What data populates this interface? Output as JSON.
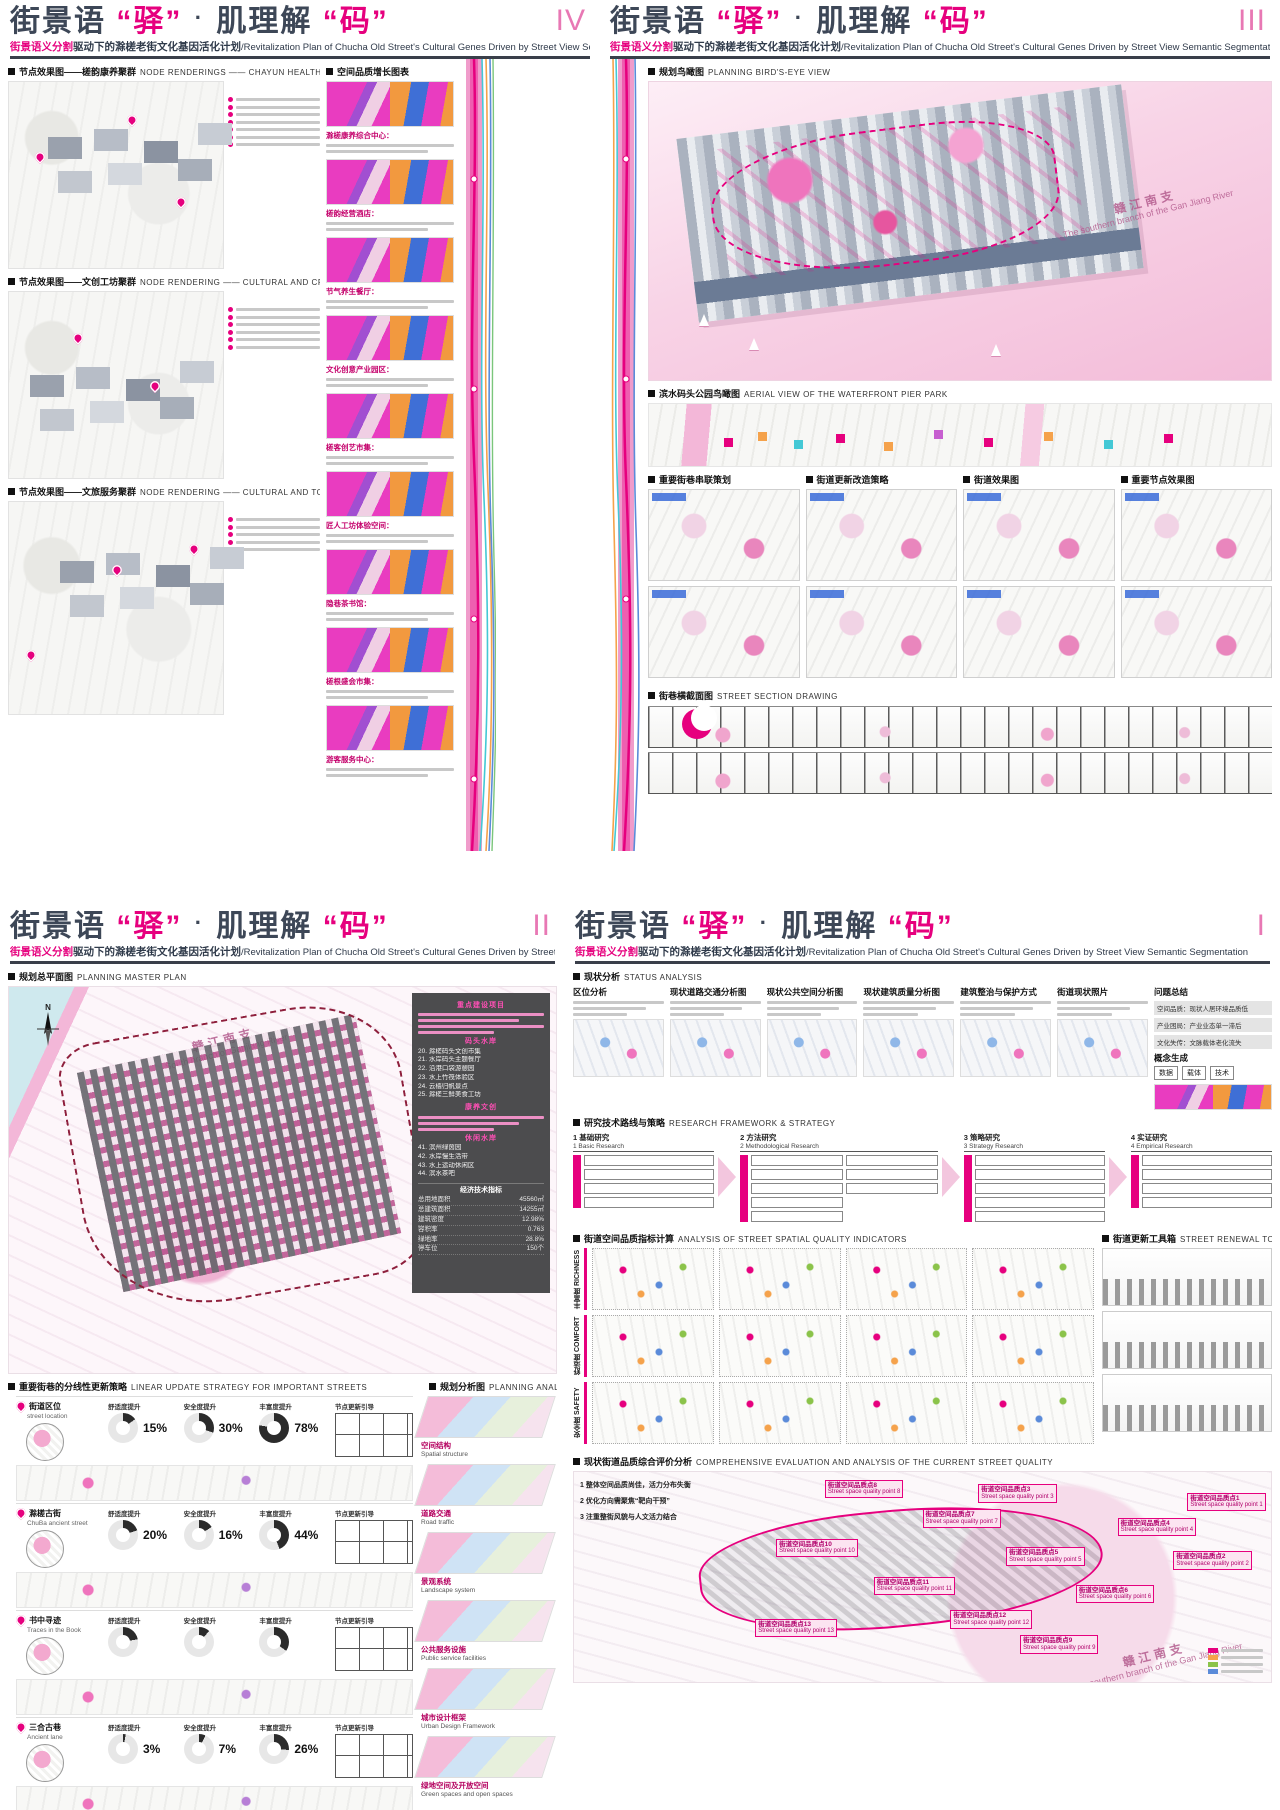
{
  "colors": {
    "accent": "#e6007e",
    "title_dark": "#3d4757",
    "band_pink": "#ee5fb0",
    "water_pink": "#f6c9de"
  },
  "shared": {
    "title": {
      "p1": "街景语",
      "q1": "“驿”",
      "dot": "·",
      "p2": "肌理解",
      "q2": "“码”"
    },
    "subtitle": {
      "pink": "街景语义分割",
      "cn": "驱动下的滁槎老街文化基因活化计划",
      "en": "/Revitalization Plan of Chucha Old Street's Cultural Genes Driven by Street View Semantic Segmentation"
    }
  },
  "panel4": {
    "numeral": "IV",
    "sec1_cn": "节点效果图——槎韵康养聚群",
    "sec1_en": "NODE RENDERINGS —— CHAYUN HEALTH CARE CLUSTER",
    "sec2_cn": "空间品质增长图表",
    "sec2_en": "",
    "sec3_cn": "节点效果图——文创工坊聚群",
    "sec3_en": "NODE RENDERING —— CULTURAL AND CREATIVE WORKSHOP CLUSTER",
    "sec4_cn": "节点效果图——文旅服务聚群",
    "sec4_en": "NODE RENDERING —— CULTURAL AND TOURISM SERVICE CLUSTER",
    "captions": [
      {
        "t": "滁槎康养综合中心："
      },
      {
        "t": "槎韵经营酒店："
      },
      {
        "t": "节气养生餐厅："
      },
      {
        "t": "文化创意产业园区："
      },
      {
        "t": "槎客创艺市集："
      },
      {
        "t": "匠人工坊体验空间："
      },
      {
        "t": "隐巷茶书馆："
      },
      {
        "t": "槎根盛会市集："
      },
      {
        "t": "游客服务中心："
      }
    ]
  },
  "panel3": {
    "numeral": "III",
    "sec1_cn": "规划鸟瞰图",
    "sec1_en": "PLANNING BIRD'S-EYE VIEW",
    "water_cn": "赣江南支",
    "water_en": "The southern branch of the Gan Jiang River",
    "sec2_cn": "滨水码头公园鸟瞰图",
    "sec2_en": "AERIAL VIEW OF THE WATERFRONT PIER PARK",
    "cols": [
      {
        "t": "重要街巷串联策划"
      },
      {
        "t": "街道更新改造策略"
      },
      {
        "t": "街道效果图"
      },
      {
        "t": "重要节点效果图"
      }
    ],
    "sec3_cn": "街巷横截面图",
    "sec3_en": "STREET SECTION DRAWING"
  },
  "panel2": {
    "numeral": "II",
    "sec1_cn": "规划总平面图",
    "sec1_en": "PLANNING MASTER PLAN",
    "compass": "N",
    "water_cn": "赣江南支",
    "water_en": "South branch of Ganjiang River",
    "legend": {
      "g1": "重点建设项目",
      "g2": "码头水岸",
      "g2_items": [
        {
          "t": "20. 滁槎码头文创市集"
        },
        {
          "t": "21. 水岸码头主题餐厅"
        },
        {
          "t": "22. 沿港口袋游憩园"
        },
        {
          "t": "23. 水上竹筏体验区"
        },
        {
          "t": "24. 云樯归帆景点"
        },
        {
          "t": "25. 滁槎三鲜美食工坊"
        }
      ],
      "g3": "康养文创",
      "g4": "休闲水岸",
      "g4_items": [
        {
          "t": "41. 滨州绿茵园"
        },
        {
          "t": "42. 水岸慢生活带"
        },
        {
          "t": "43. 水上运动休闲区"
        },
        {
          "t": "44. 滨水茶吧"
        }
      ]
    },
    "metrics": {
      "title": "经济技术指标",
      "rows": [
        {
          "k": "总用地面积",
          "v": "45560㎡"
        },
        {
          "k": "总建筑面积",
          "v": "14255㎡"
        },
        {
          "k": "建筑密度",
          "v": "12.98%"
        },
        {
          "k": "容积率",
          "v": "0.763"
        },
        {
          "k": "绿地率",
          "v": "28.8%"
        },
        {
          "k": "停车位",
          "v": "150个"
        }
      ]
    },
    "sec2_cn": "重要街巷的分线性更新策略",
    "sec2_en": "LINEAR UPDATE STRATEGY FOR IMPORTANT STREETS",
    "sec3_cn": "规划分析图",
    "sec3_en": "PLANNING ANALYSIS DIAGRAMS",
    "streets": [
      {
        "cn": "街道区位",
        "en": "street location",
        "l0": "舒适度提升",
        "v0": "15%",
        "a0": "--p:15",
        "l1": "安全度提升",
        "v1": "30%",
        "a1": "--p:30",
        "l2": "丰富度提升",
        "v2": "78%",
        "a2": "--p:78",
        "tail": "节点更新引导"
      },
      {
        "cn": "滁槎古街",
        "en": "ChuBa ancient street",
        "l0": "舒适度提升",
        "v0": "20%",
        "a0": "--p:20",
        "l1": "安全度提升",
        "v1": "16%",
        "a1": "--p:16",
        "l2": "丰富度提升",
        "v2": "44%",
        "a2": "--p:44",
        "tail": "节点更新引导"
      },
      {
        "cn": "书中寻迹",
        "en": "Traces in the Book",
        "l0": "舒适度提升",
        "v0": "",
        "a0": "--p:22",
        "l1": "安全度提升",
        "v1": "",
        "a1": "--p:12",
        "l2": "丰富度提升",
        "v2": "",
        "a2": "--p:35",
        "tail": "节点更新引导"
      },
      {
        "cn": "三合古巷",
        "en": "Ancient lane",
        "l0": "舒适度提升",
        "v0": "3%",
        "a0": "--p:3",
        "l1": "安全度提升",
        "v1": "7%",
        "a1": "--p:7",
        "l2": "丰富度提升",
        "v2": "26%",
        "a2": "--p:26",
        "tail": "节点更新引导"
      }
    ],
    "layers": [
      {
        "cn": "空间结构",
        "en": "Spatial structure"
      },
      {
        "cn": "道路交通",
        "en": "Road traffic"
      },
      {
        "cn": "景观系统",
        "en": "Landscape system"
      },
      {
        "cn": "公共服务设施",
        "en": "Public service facilities"
      },
      {
        "cn": "城市设计框架",
        "en": "Urban Design Framework"
      },
      {
        "cn": "绿地空间及开放空间",
        "en": "Green spaces and open spaces"
      }
    ]
  },
  "panel1": {
    "numeral": "I",
    "sec1_cn": "现状分析",
    "sec1_en": "STATUS ANALYSIS",
    "status_cols": [
      {
        "t": "区位分析"
      },
      {
        "t": "现状道路交通分析图"
      },
      {
        "t": "现状公共空间分析图"
      },
      {
        "t": "现状建筑质量分析图"
      },
      {
        "t": "建筑整治与保护方式"
      },
      {
        "t": "街道现状照片"
      }
    ],
    "problem_title": "问题总结",
    "problems": [
      {
        "t": "空间品质：现状人居环境品质低"
      },
      {
        "t": "产业困局：产业业态单一滞后"
      },
      {
        "t": "文化失传：文脉载体老化流失"
      }
    ],
    "concept_title": "概念生成",
    "concept_keys": [
      {
        "t": "数据"
      },
      {
        "t": "载体"
      },
      {
        "t": "技术"
      }
    ],
    "sec2_cn": "研究技术路线与策略",
    "sec2_en": "RESEARCH FRAMEWORK & STRATEGY",
    "stages": [
      {
        "cn": "1 基础研究",
        "en": "1 Basic Research"
      },
      {
        "cn": "2 方法研究",
        "en": "2 Methodological Research"
      },
      {
        "cn": "3 策略研究",
        "en": "3 Strategy Research"
      },
      {
        "cn": "4 实证研究",
        "en": "4 Empirical Research"
      }
    ],
    "sec3_cn": "街道空间品质指标计算",
    "sec3_en": "ANALYSIS OF STREET SPATIAL QUALITY INDICATORS",
    "rows": [
      {
        "cn": "丰富度",
        "en": "RICHNESS"
      },
      {
        "cn": "舒适度",
        "en": "COMFORT"
      },
      {
        "cn": "安全度",
        "en": "SAFETY"
      }
    ],
    "sec4_cn": "街道更新工具箱",
    "sec4_en": "STREET RENEWAL TOOLKIT",
    "sec5_cn": "现状街道品质综合评价分析",
    "sec5_en": "COMPREHENSIVE EVALUATION AND ANALYSIS OF THE CURRENT STREET QUALITY",
    "notes": [
      {
        "t": "1 整体空间品质尚佳，活力分布失衡"
      },
      {
        "t": "2 优化方向需聚焦“靶向干预”"
      },
      {
        "t": "3 注重整街风貌与人文活力结合"
      }
    ],
    "points": [
      {
        "cn": "街道空间品质点1",
        "en": "Street space quality point 1",
        "pos": "left:88%;top:10%"
      },
      {
        "cn": "街道空间品质点2",
        "en": "Street space quality point 2",
        "pos": "left:86%;top:38%"
      },
      {
        "cn": "街道空间品质点3",
        "en": "Street space quality point 3",
        "pos": "left:58%;top:6%"
      },
      {
        "cn": "街道空间品质点4",
        "en": "Street space quality point 4",
        "pos": "left:78%;top:22%"
      },
      {
        "cn": "街道空间品质点5",
        "en": "Street space quality point 5",
        "pos": "left:62%;top:36%"
      },
      {
        "cn": "街道空间品质点6",
        "en": "Street space quality point 6",
        "pos": "left:72%;top:54%"
      },
      {
        "cn": "街道空间品质点7",
        "en": "Street space quality point 7",
        "pos": "left:50%;top:18%"
      },
      {
        "cn": "街道空间品质点8",
        "en": "Street space quality point 8",
        "pos": "left:36%;top:4%"
      },
      {
        "cn": "街道空间品质点9",
        "en": "Street space quality point 9",
        "pos": "left:64%;top:78%"
      },
      {
        "cn": "街道空间品质点10",
        "en": "Street space quality point 10",
        "pos": "left:29%;top:32%"
      },
      {
        "cn": "街道空间品质点11",
        "en": "Street space quality point 11",
        "pos": "left:43%;top:50%"
      },
      {
        "cn": "街道空间品质点12",
        "en": "Street space quality point 12",
        "pos": "left:54%;top:66%"
      },
      {
        "cn": "街道空间品质点13",
        "en": "Street space quality point 13",
        "pos": "left:26%;top:70%"
      }
    ],
    "water_cn": "赣江南支",
    "water_en": "The southern branch of the Gan Jiang River",
    "legend_colors": [
      {
        "c": "background:#e6007e"
      },
      {
        "c": "background:#f5a24b"
      },
      {
        "c": "background:#8bc34a"
      },
      {
        "c": "background:#5b8bd9"
      }
    ]
  }
}
